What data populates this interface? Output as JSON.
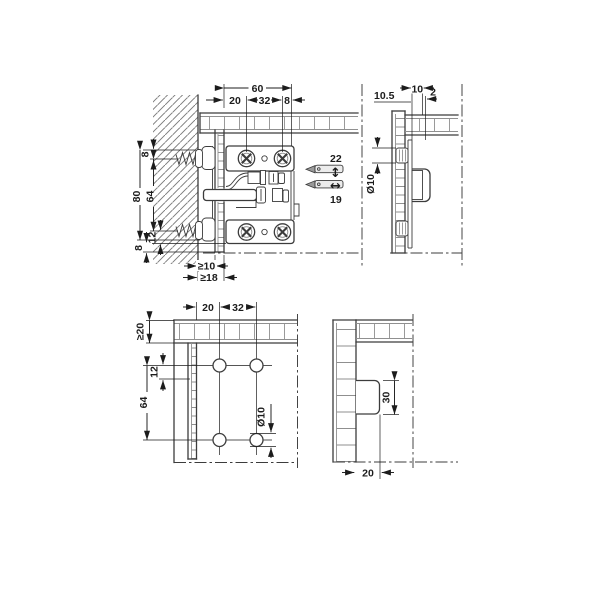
{
  "drawing_type": "technical-installation-drawing",
  "colors": {
    "line": "#3c3c3c",
    "dim": "#1c1c1c",
    "grid": "#909090",
    "hatch": "#7a7a7a",
    "background": "#ffffff"
  },
  "views": {
    "front": {
      "dims": {
        "total_width": "60",
        "offset": "20",
        "hole_spacing": "32",
        "edge": "8",
        "top_margin": "8",
        "total_height": "80",
        "screw_spacing": "64",
        "bottom_offset": "12",
        "bottom_margin": "8",
        "wall_gap_min": "≥10",
        "wall_depth_min": "≥18"
      },
      "adjustment": {
        "vertical_range": "22",
        "vertical_arrow": "↕",
        "horizontal_range": "19",
        "horizontal_arrow": "↔"
      }
    },
    "side": {
      "dims": {
        "plate_offset": "10.5",
        "depth": "10",
        "gap": "2",
        "hole_dia": "Ø10"
      }
    },
    "drill_front": {
      "dims": {
        "offset": "20",
        "hole_spacing": "32",
        "top_min": "≥20",
        "row_offset": "12",
        "row_spacing": "64",
        "hole_dia": "Ø10"
      }
    },
    "drill_side": {
      "dims": {
        "housing_height": "30",
        "housing_depth": "20"
      }
    }
  }
}
